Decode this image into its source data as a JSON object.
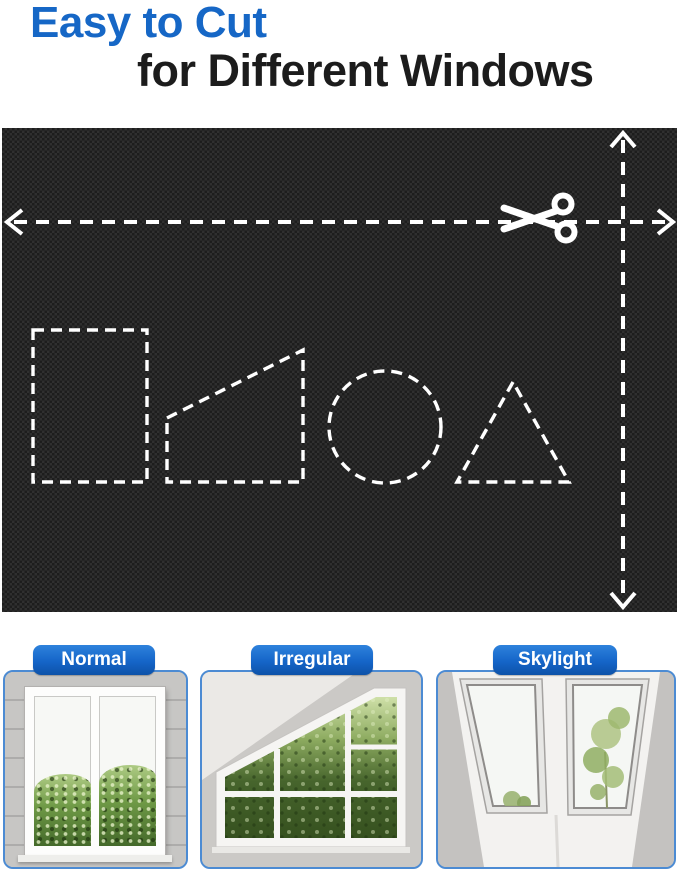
{
  "header": {
    "title_line1": "Easy to Cut",
    "title_line2": "for Different Windows",
    "accent_color": "#1667C6",
    "text_color": "#1C1C1C"
  },
  "fabric_panel": {
    "material": "black woven blackout fabric swatch",
    "fabric_color": "#1D1D1D",
    "dash_color": "#FFFFFF",
    "icons": [
      "scissors-icon",
      "width-cut-arrow",
      "height-cut-arrow"
    ],
    "cut_shapes": [
      "rectangle",
      "trapezoid",
      "circle",
      "triangle"
    ]
  },
  "window_types": {
    "label_bg_color": "#1565C8",
    "label_text_color": "#FFFFFF",
    "card_border_color": "#4C8BD3",
    "cards": [
      {
        "label": "Normal"
      },
      {
        "label": "Irregular"
      },
      {
        "label": "Skylight"
      }
    ]
  }
}
